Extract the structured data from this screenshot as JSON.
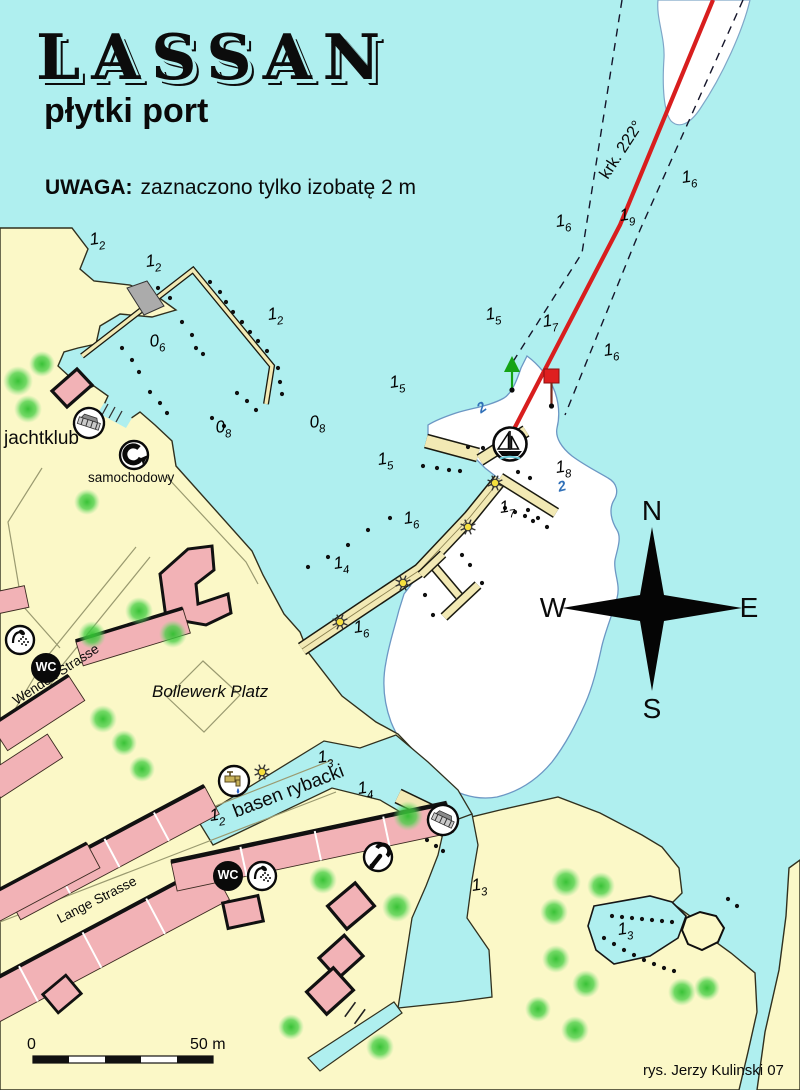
{
  "colors": {
    "water": "#AFEFEF",
    "land": "#FBF8C7",
    "building": "#F2B2B6",
    "pier": "#F2E9B4",
    "shallow_white": "#FFFFFF",
    "contour_blue": "#6C97C4",
    "course_red": "#D81E1E",
    "beacon_green": "#15A315",
    "beacon_red": "#DE1F1F",
    "tree_green": "#3BCB3B"
  },
  "header": {
    "title": "LASSAN",
    "subtitle": "płytki port",
    "warning_bold": "UWAGA:",
    "warning_text": "zaznaczono tylko izobatę 2 m"
  },
  "course": {
    "label": "krk. 222°"
  },
  "compass": {
    "north": "N",
    "east": "E",
    "south": "S",
    "west": "W"
  },
  "scale_bar": {
    "start_label": "0",
    "end_label": "50 m"
  },
  "attribution": "rys. Jerzy Kulinski 07",
  "facility_labels": {
    "yacht_club": "jachtklub",
    "car_crane": "samochodowy",
    "wc": "WC"
  },
  "street_labels": {
    "wenden": "Wenden Strasse",
    "lange": "Lange Strasse",
    "bollewerk": "Bollewerk Platz",
    "fishing_basin": "basen rybacki"
  },
  "depth_soundings": [
    {
      "whole": "1",
      "decimal": "2",
      "x": 90,
      "y": 230
    },
    {
      "whole": "1",
      "decimal": "2",
      "x": 146,
      "y": 252
    },
    {
      "whole": "1",
      "decimal": "2",
      "x": 268,
      "y": 305
    },
    {
      "whole": "0",
      "decimal": "6",
      "x": 150,
      "y": 332
    },
    {
      "whole": "0",
      "decimal": "8",
      "x": 216,
      "y": 418
    },
    {
      "whole": "0",
      "decimal": "8",
      "x": 310,
      "y": 413
    },
    {
      "whole": "1",
      "decimal": "5",
      "x": 486,
      "y": 305
    },
    {
      "whole": "1",
      "decimal": "6",
      "x": 556,
      "y": 212
    },
    {
      "whole": "1",
      "decimal": "9",
      "x": 620,
      "y": 206
    },
    {
      "whole": "1",
      "decimal": "6",
      "x": 682,
      "y": 168
    },
    {
      "whole": "1",
      "decimal": "7",
      "x": 543,
      "y": 312
    },
    {
      "whole": "1",
      "decimal": "6",
      "x": 604,
      "y": 341
    },
    {
      "whole": "1",
      "decimal": "5",
      "x": 390,
      "y": 373
    },
    {
      "whole": "1",
      "decimal": "5",
      "x": 378,
      "y": 450
    },
    {
      "whole": "1",
      "decimal": "6",
      "x": 404,
      "y": 509
    },
    {
      "whole": "1",
      "decimal": "8",
      "x": 556,
      "y": 458
    },
    {
      "whole": "1",
      "decimal": "7",
      "x": 500,
      "y": 498
    },
    {
      "whole": "1",
      "decimal": "4",
      "x": 334,
      "y": 554
    },
    {
      "whole": "1",
      "decimal": "6",
      "x": 354,
      "y": 618
    },
    {
      "whole": "1",
      "decimal": "3",
      "x": 318,
      "y": 748
    },
    {
      "whole": "1",
      "decimal": "4",
      "x": 358,
      "y": 779
    },
    {
      "whole": "1",
      "decimal": "2",
      "x": 210,
      "y": 806
    },
    {
      "whole": "1",
      "decimal": "3",
      "x": 472,
      "y": 876
    },
    {
      "whole": "1",
      "decimal": "3",
      "x": 618,
      "y": 920
    }
  ],
  "isobath_labels": [
    {
      "text": "2",
      "x": 478,
      "y": 400,
      "rot": -35
    },
    {
      "text": "2",
      "x": 558,
      "y": 479,
      "rot": -15
    }
  ]
}
